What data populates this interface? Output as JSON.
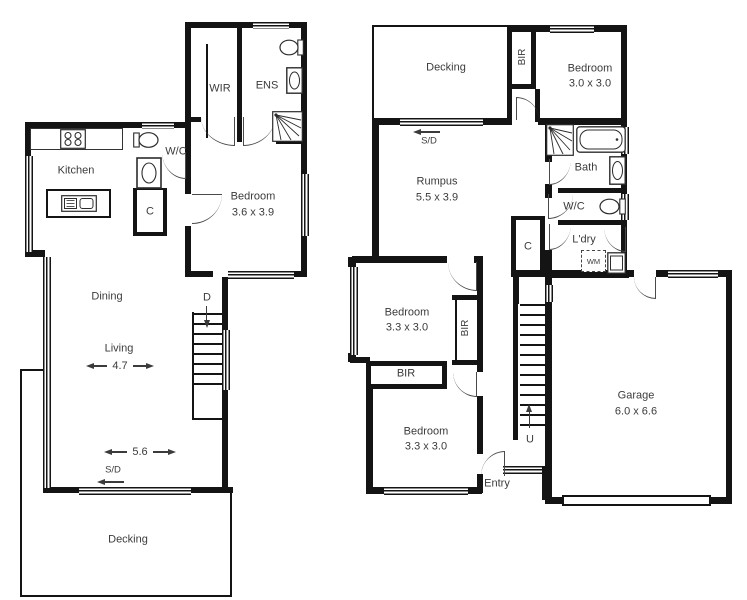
{
  "colors": {
    "wall": "#141414",
    "line": "#3b3b3b",
    "text": "#3b3b3b",
    "background": "#ffffff"
  },
  "plan_left": {
    "rooms": {
      "kitchen": {
        "label": "Kitchen"
      },
      "wir": {
        "label": "WIR"
      },
      "ens": {
        "label": "ENS"
      },
      "wc": {
        "label": "W/C"
      },
      "cupboard": {
        "label": "C"
      },
      "bedroom": {
        "label": "Bedroom",
        "dims": "3.6 x 3.9"
      },
      "dining": {
        "label": "Dining"
      },
      "living": {
        "label": "Living"
      },
      "decking": {
        "label": "Decking"
      }
    },
    "annotations": {
      "dim_living_width": "4.7",
      "dim_living_length": "5.6",
      "sliding_door": "S/D",
      "stairs_down": "D"
    }
  },
  "plan_right": {
    "rooms": {
      "decking": {
        "label": "Decking"
      },
      "robe_top": {
        "label": "BIR"
      },
      "bedroom_top": {
        "label": "Bedroom",
        "dims": "3.0 x 3.0"
      },
      "rumpus": {
        "label": "Rumpus",
        "dims": "5.5 x 3.9"
      },
      "bath": {
        "label": "Bath"
      },
      "wc": {
        "label": "W/C"
      },
      "laundry": {
        "label": "L'dry"
      },
      "cupboard": {
        "label": "C"
      },
      "bedroom_mid": {
        "label": "Bedroom",
        "dims": "3.3 x 3.0"
      },
      "robe_mid": {
        "label": "BIR"
      },
      "robe_low": {
        "label": "BIR"
      },
      "bedroom_low": {
        "label": "Bedroom",
        "dims": "3.3 x 3.0"
      },
      "entry": {
        "label": "Entry"
      },
      "garage": {
        "label": "Garage",
        "dims": "6.0 x 6.6"
      }
    },
    "annotations": {
      "sliding_door": "S/D",
      "stairs_up": "U",
      "washing_machine": "WM"
    }
  }
}
